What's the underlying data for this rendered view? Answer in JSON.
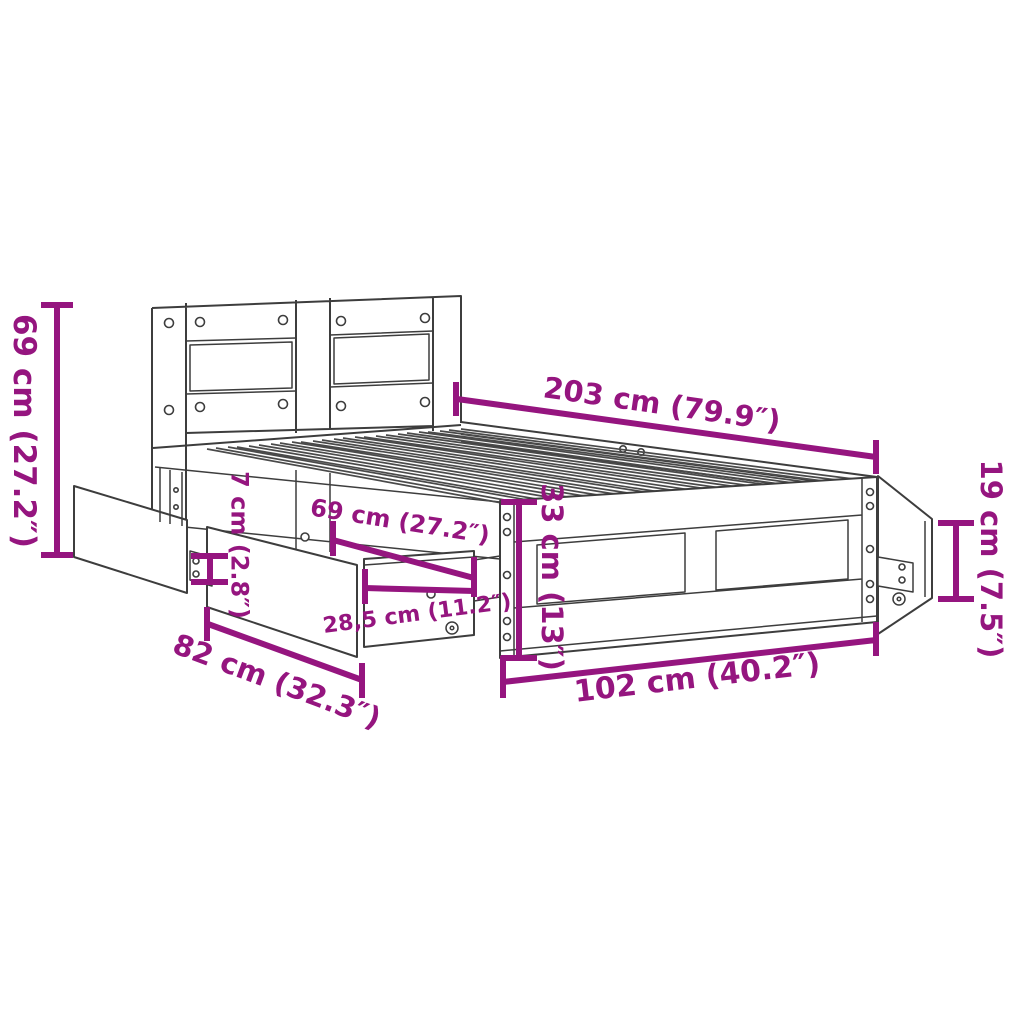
{
  "colors": {
    "dimension": "#95157F",
    "outline": "#3D3D3D",
    "background": "#FFFFFF"
  },
  "diagram": {
    "type": "product-dimension-diagram",
    "subject": "bed frame with headboard and underbed storage drawers",
    "unit_style": "centimeters with inches in parentheses",
    "dims": {
      "headboard_height": {
        "label": "69 cm (27.2″)",
        "orientation": "vertical"
      },
      "bed_length": {
        "label": "203 cm (79.9″)",
        "orientation": "diagonal"
      },
      "drawer_span": {
        "label": "69 cm (27.2″)",
        "orientation": "diagonal"
      },
      "rail_height": {
        "label": "7 cm (2.8″)",
        "orientation": "vertical"
      },
      "frame_height": {
        "label": "33 cm (13″)",
        "orientation": "vertical"
      },
      "drawer_height": {
        "label": "19 cm (7.5″)",
        "orientation": "vertical"
      },
      "drawer_front_width": {
        "label": "28,5 cm (11.2″)",
        "orientation": "diagonal"
      },
      "drawer_depth": {
        "label": "82 cm (32.3″)",
        "orientation": "diagonal"
      },
      "bed_width": {
        "label": "102 cm (40.2″)",
        "orientation": "diagonal"
      }
    }
  }
}
